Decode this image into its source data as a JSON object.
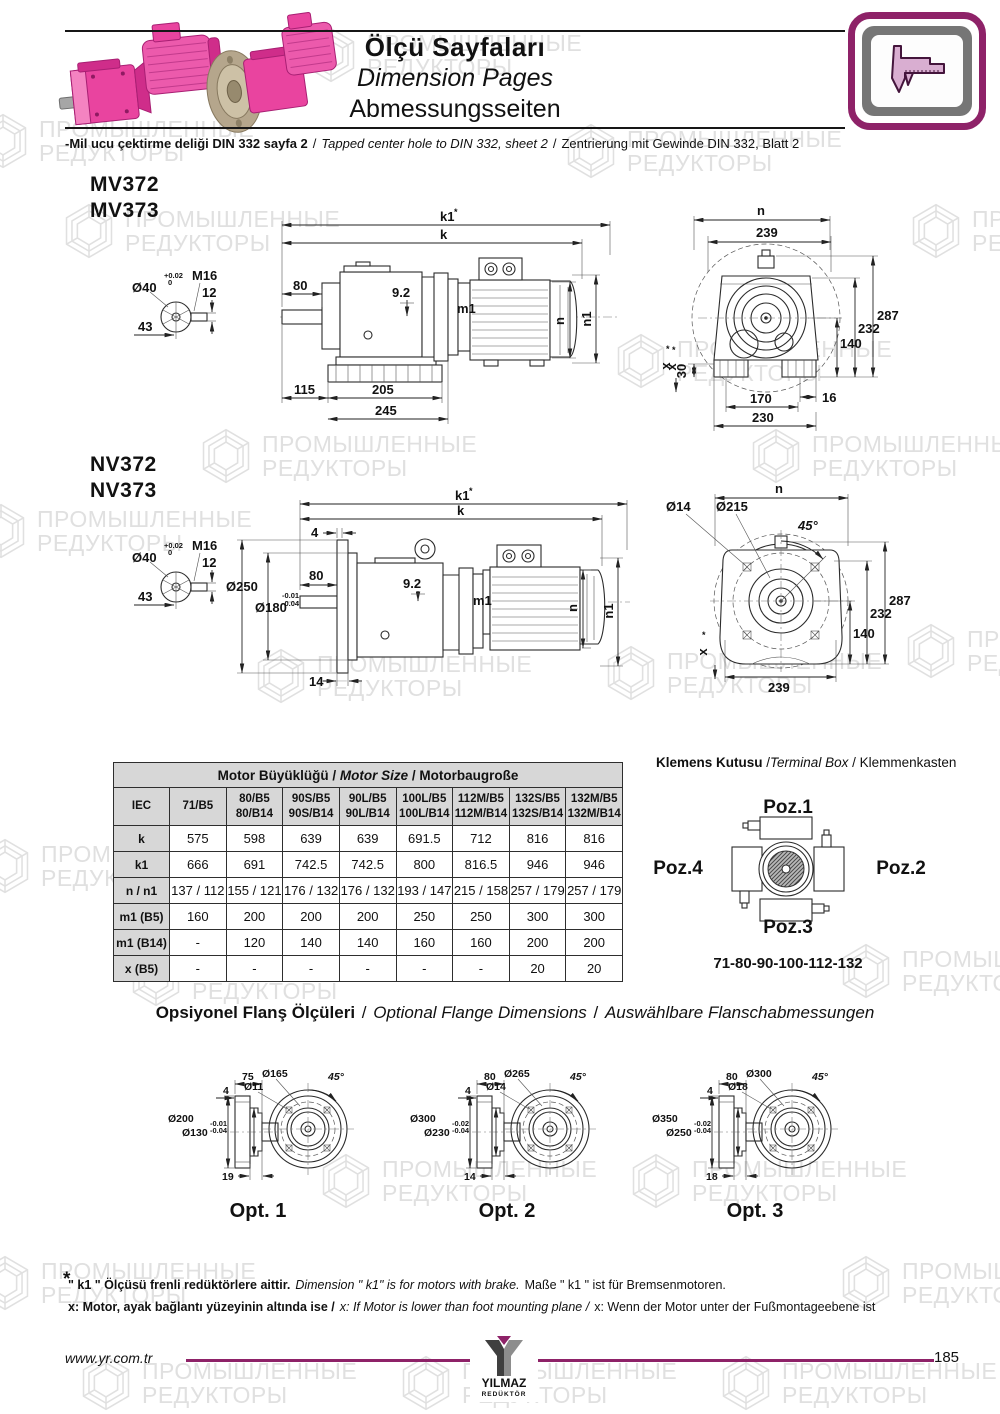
{
  "watermark": {
    "line1": "ПРОМЫШЛЕННЫЕ",
    "line2": "РЕДУКТОРЫ"
  },
  "header": {
    "title_tr": "Ölçü Sayfaları",
    "title_en": "Dimension Pages",
    "title_de": "Abmessungsseiten"
  },
  "note": {
    "tr": "-Mil ucu çektirme deliği DIN 332 sayfa 2",
    "sep": "/",
    "en": "Tapped center hole to DIN 332, sheet 2",
    "de": "Zentrierung mit Gewinde DIN 332, Blatt 2"
  },
  "mv": {
    "model1": "MV372",
    "model2": "MV373",
    "shaft": {
      "dia": "Ø40",
      "tol_top": "+0.02",
      "tol_bot": "0",
      "thread": "M16",
      "d12": "12",
      "d43": "43"
    },
    "side": {
      "k1": "k1",
      "star": "*",
      "k": "k",
      "d80": "80",
      "d92": "9.2",
      "m1": "m1",
      "n": "n",
      "n1": "n1",
      "d115": "115",
      "d205": "205",
      "d245": "245",
      "x": "x"
    },
    "end": {
      "n": "n",
      "d239": "239",
      "d287": "287",
      "d232": "232",
      "d140": "140",
      "d30": "30",
      "x": "x",
      "d16": "16",
      "d170": "170",
      "d230": "230"
    }
  },
  "nv": {
    "model1": "NV372",
    "model2": "NV373",
    "shaft": {
      "dia": "Ø40",
      "tol_top": "+0.02",
      "tol_bot": "0",
      "thread": "M16",
      "d12": "12",
      "d43": "43"
    },
    "side": {
      "k1": "k1",
      "star": "*",
      "k": "k",
      "d4": "4",
      "dia250": "Ø250",
      "dia180": "Ø180",
      "tol1": "-0.01",
      "tol2": "-0.04",
      "d80": "80",
      "d92": "9.2",
      "m1": "m1",
      "n": "n",
      "n1": "n1",
      "d14": "14"
    },
    "end": {
      "n": "n",
      "dia14": "Ø14",
      "dia215": "Ø215",
      "angle": "45°",
      "d287": "287",
      "d232": "232",
      "d140": "140",
      "d239": "239",
      "x": "x"
    }
  },
  "table": {
    "title_tr": "Motor Büyüklüğü",
    "title_en": "Motor Size",
    "title_de": "Motorbaugroße",
    "sep": " / ",
    "col0": "IEC",
    "columns": [
      {
        "l1": "71/B5",
        "l2": ""
      },
      {
        "l1": "80/B5",
        "l2": "80/B14"
      },
      {
        "l1": "90S/B5",
        "l2": "90S/B14"
      },
      {
        "l1": "90L/B5",
        "l2": "90L/B14"
      },
      {
        "l1": "100L/B5",
        "l2": "100L/B14"
      },
      {
        "l1": "112M/B5",
        "l2": "112M/B14"
      },
      {
        "l1": "132S/B5",
        "l2": "132S/B14"
      },
      {
        "l1": "132M/B5",
        "l2": "132M/B14"
      }
    ],
    "rows": [
      {
        "label": "k",
        "values": [
          "575",
          "598",
          "639",
          "639",
          "691.5",
          "712",
          "816",
          "816"
        ]
      },
      {
        "label": "k1",
        "values": [
          "666",
          "691",
          "742.5",
          "742.5",
          "800",
          "816.5",
          "946",
          "946"
        ]
      },
      {
        "label": "n / n1",
        "values": [
          "137 / 112",
          "155 / 121",
          "176 / 132",
          "176 / 132",
          "193 / 147",
          "215 / 158",
          "257 / 179",
          "257 / 179"
        ]
      },
      {
        "label": "m1 (B5)",
        "values": [
          "160",
          "200",
          "200",
          "200",
          "250",
          "250",
          "300",
          "300"
        ]
      },
      {
        "label": "m1 (B14)",
        "values": [
          "-",
          "120",
          "140",
          "140",
          "160",
          "160",
          "200",
          "200"
        ]
      },
      {
        "label": "x (B5)",
        "values": [
          "-",
          "-",
          "-",
          "-",
          "-",
          "-",
          "20",
          "20"
        ]
      }
    ]
  },
  "terminal_box": {
    "title_tr": "Klemens Kutusu",
    "sep1": " /",
    "title_en": "Terminal Box",
    "sep2": " / ",
    "title_de": "Klemmenkasten",
    "poz1": "Poz.1",
    "poz2": "Poz.2",
    "poz3": "Poz.3",
    "poz4": "Poz.4",
    "sizes": "71-80-90-100-112-132"
  },
  "flange": {
    "title_tr": "Opsiyonel Flanş Ölçüleri",
    "sep": " / ",
    "title_en": "Optional Flange Dimensions",
    "title_de": "Auswählbare Flanschabmessungen",
    "opts": [
      {
        "label": "Opt. 1",
        "top": "75",
        "lip": "4",
        "outer": "Ø200",
        "pilot": "Ø130",
        "tol1": "-0.01",
        "tol2": "-0.04",
        "bottom": "19",
        "bolt_circle": "Ø165",
        "hole": "Ø11",
        "angle": "45°"
      },
      {
        "label": "Opt. 2",
        "top": "80",
        "lip": "4",
        "outer": "Ø300",
        "pilot": "Ø230",
        "tol1": "-0.02",
        "tol2": "-0.04",
        "bottom": "14",
        "bolt_circle": "Ø265",
        "hole": "Ø14",
        "angle": "45°"
      },
      {
        "label": "Opt. 3",
        "top": "80",
        "lip": "4",
        "outer": "Ø350",
        "pilot": "Ø250",
        "tol1": "-0.02",
        "tol2": "-0.04",
        "bottom": "18",
        "bolt_circle": "Ø300",
        "hole": "Ø18",
        "angle": "45°"
      }
    ]
  },
  "footnotes": {
    "star": "*",
    "k1_tr": "\" k1 \" Ölçüsü frenli redüktörlere aittir.",
    "k1_en": "Dimension \" k1\" is for motors with brake.",
    "k1_de": "Maße \" k1 \" ist für Bremsenmotoren.",
    "x_tr": "x: Motor, ayak bağlantı yüzeyinin altında ise /",
    "x_en": "x: If Motor is lower than foot mounting plane /",
    "x_de": "x: Wenn der Motor unter der Fußmontageebene ist"
  },
  "footer": {
    "website": "www.yr.com.tr",
    "brand": "YILMAZ",
    "brand_sub": "REDÜKTÖR",
    "page": "185"
  }
}
